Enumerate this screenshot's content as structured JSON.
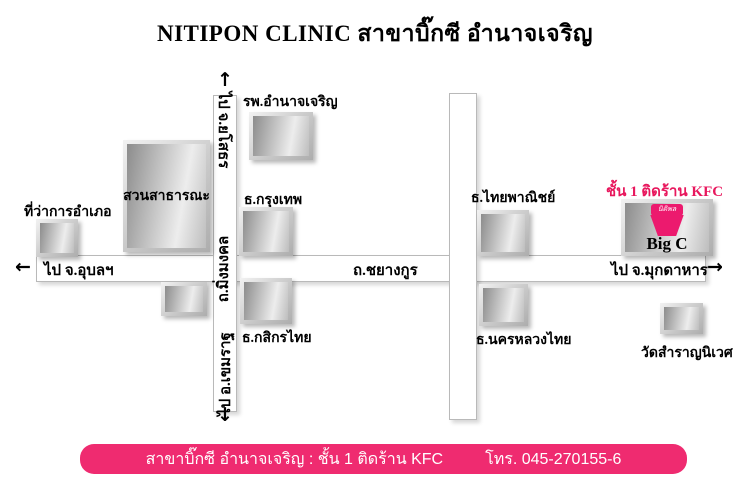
{
  "title": "NITIPON CLINIC สาขาบิ๊กซี อำนาจเจริญ",
  "colors": {
    "banner_pink": "#EF2B70",
    "note_pink": "#E8175D",
    "logo_pink": "#EC1A6E",
    "building_gray": "#8c8c8c"
  },
  "roads": {
    "horizontal": {
      "to_left": "ไป จ.อุบลฯ",
      "name": "ถ.ชยางกูร",
      "to_right": "ไป จ.มุกดาหาร"
    },
    "vertical": {
      "to_top": "ไป จ.ยโสธร",
      "name": "ถ.มิ่งมงคล",
      "to_bottom": "ไป อ.เขมราฐ"
    }
  },
  "places": {
    "district_office": "ที่ว่าการอำเภอ",
    "park": "สวนสาธารณะ",
    "hospital": "รพ.อำนาจเจริญ",
    "bangkok_bank": "ธ.กรุงเทพ",
    "kasikorn_bank": "ธ.กสิกรไทย",
    "scb_bank": "ธ.ไทยพาณิชย์",
    "nakornluang_bank": "ธ.นครหลวงไทย",
    "temple": "วัดสำราญนิเวศ"
  },
  "bigc": {
    "note": "ชั้น 1 ติดร้าน KFC",
    "logo": "นิติพล",
    "label": "Big C"
  },
  "footer": {
    "branch": "สาขาบิ๊กซี อำนาจเจริญ : ชั้น 1 ติดร้าน KFC",
    "phone": "โทร. 045-270155-6"
  }
}
